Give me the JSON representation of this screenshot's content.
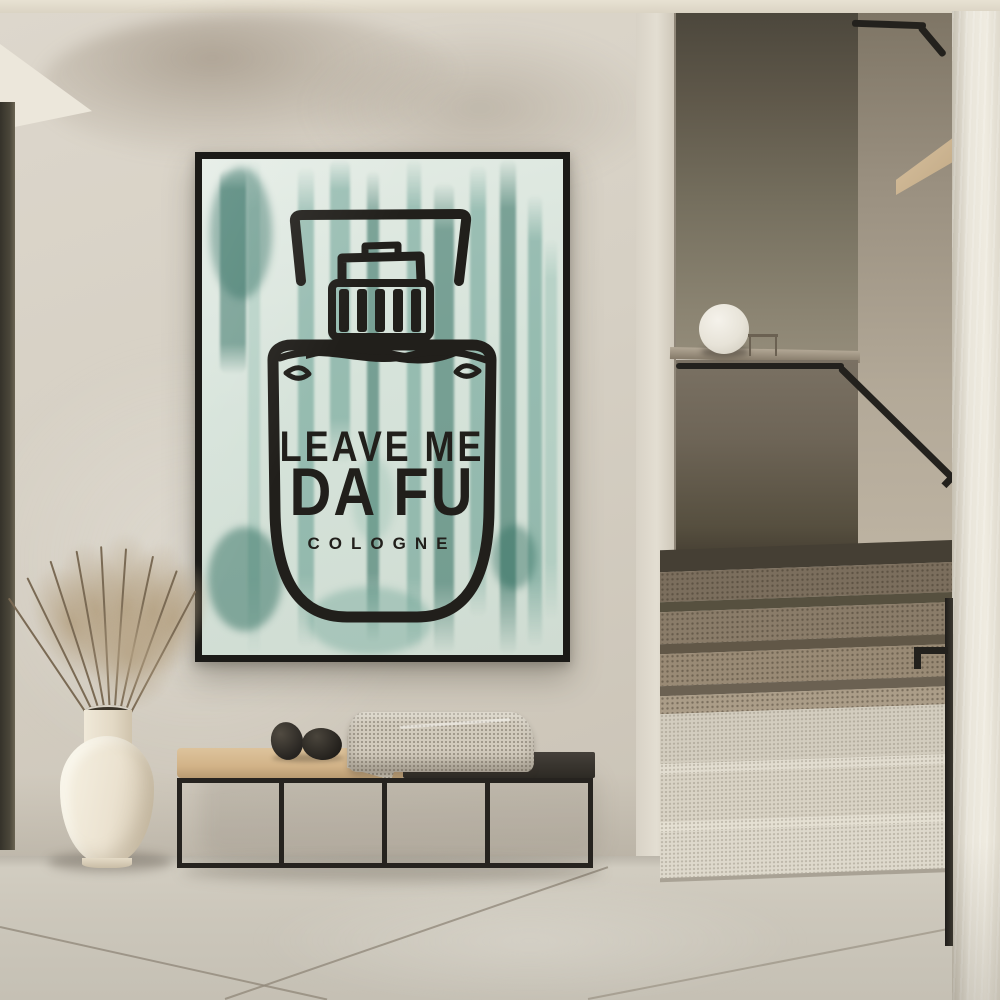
{
  "scene": {
    "type": "interior-photograph",
    "description": "Minimalist hallway with a framed cologne art print on a plaster wall, a metal bench with pebbles and a knit blanket, a cream vase with dried grass, and a terrazzo staircase with black handrails and a sphere lamp",
    "poster": {
      "line1": "LEAVE ME",
      "line2": "DA FU",
      "line3": "COLOGNE",
      "subject": "perfume-bottle-linocut-on-teal-watercolor-drips",
      "background_color": "#d9e4dc",
      "watercolor_color": "#3f8677",
      "ink_color": "#211f1b",
      "frame_color": "#1b1a17"
    },
    "objects": {
      "lamp": "white sphere lamp on stair parapet",
      "bench": "black metal frame bench, tan cushion and dark wood seat",
      "bench_decor": "two black pebbles and draped knit blanket",
      "vase": "cream ceramic vase with dried grass plumes",
      "stairs": "terrazzo steps, dark upper flight in shadow, light lower flight",
      "handrails": "black flat-bar handrails"
    },
    "palette": {
      "ceiling": "#e0d9ca",
      "wall": "#d6d0c4",
      "wall_smudge": "#7a6a57",
      "door_edge": "#454135",
      "recess_wall": "#6e6557",
      "inner_wall": "#b3a998",
      "wood_wedge": "#ccb491",
      "white_column": "#ebe7dc",
      "rail_black": "#23211d",
      "step_dark": "#8a7c69",
      "step_light": "#d9d3c5",
      "floor": "#ccc7bb",
      "bench_cushion": "#d2b388",
      "bench_seat": "#2d2a24",
      "blanket": "#d2cbbd",
      "pebble": "#262320",
      "vase": "#ece4d3",
      "plant": "#b4a285",
      "lamp": "#efece4"
    }
  }
}
